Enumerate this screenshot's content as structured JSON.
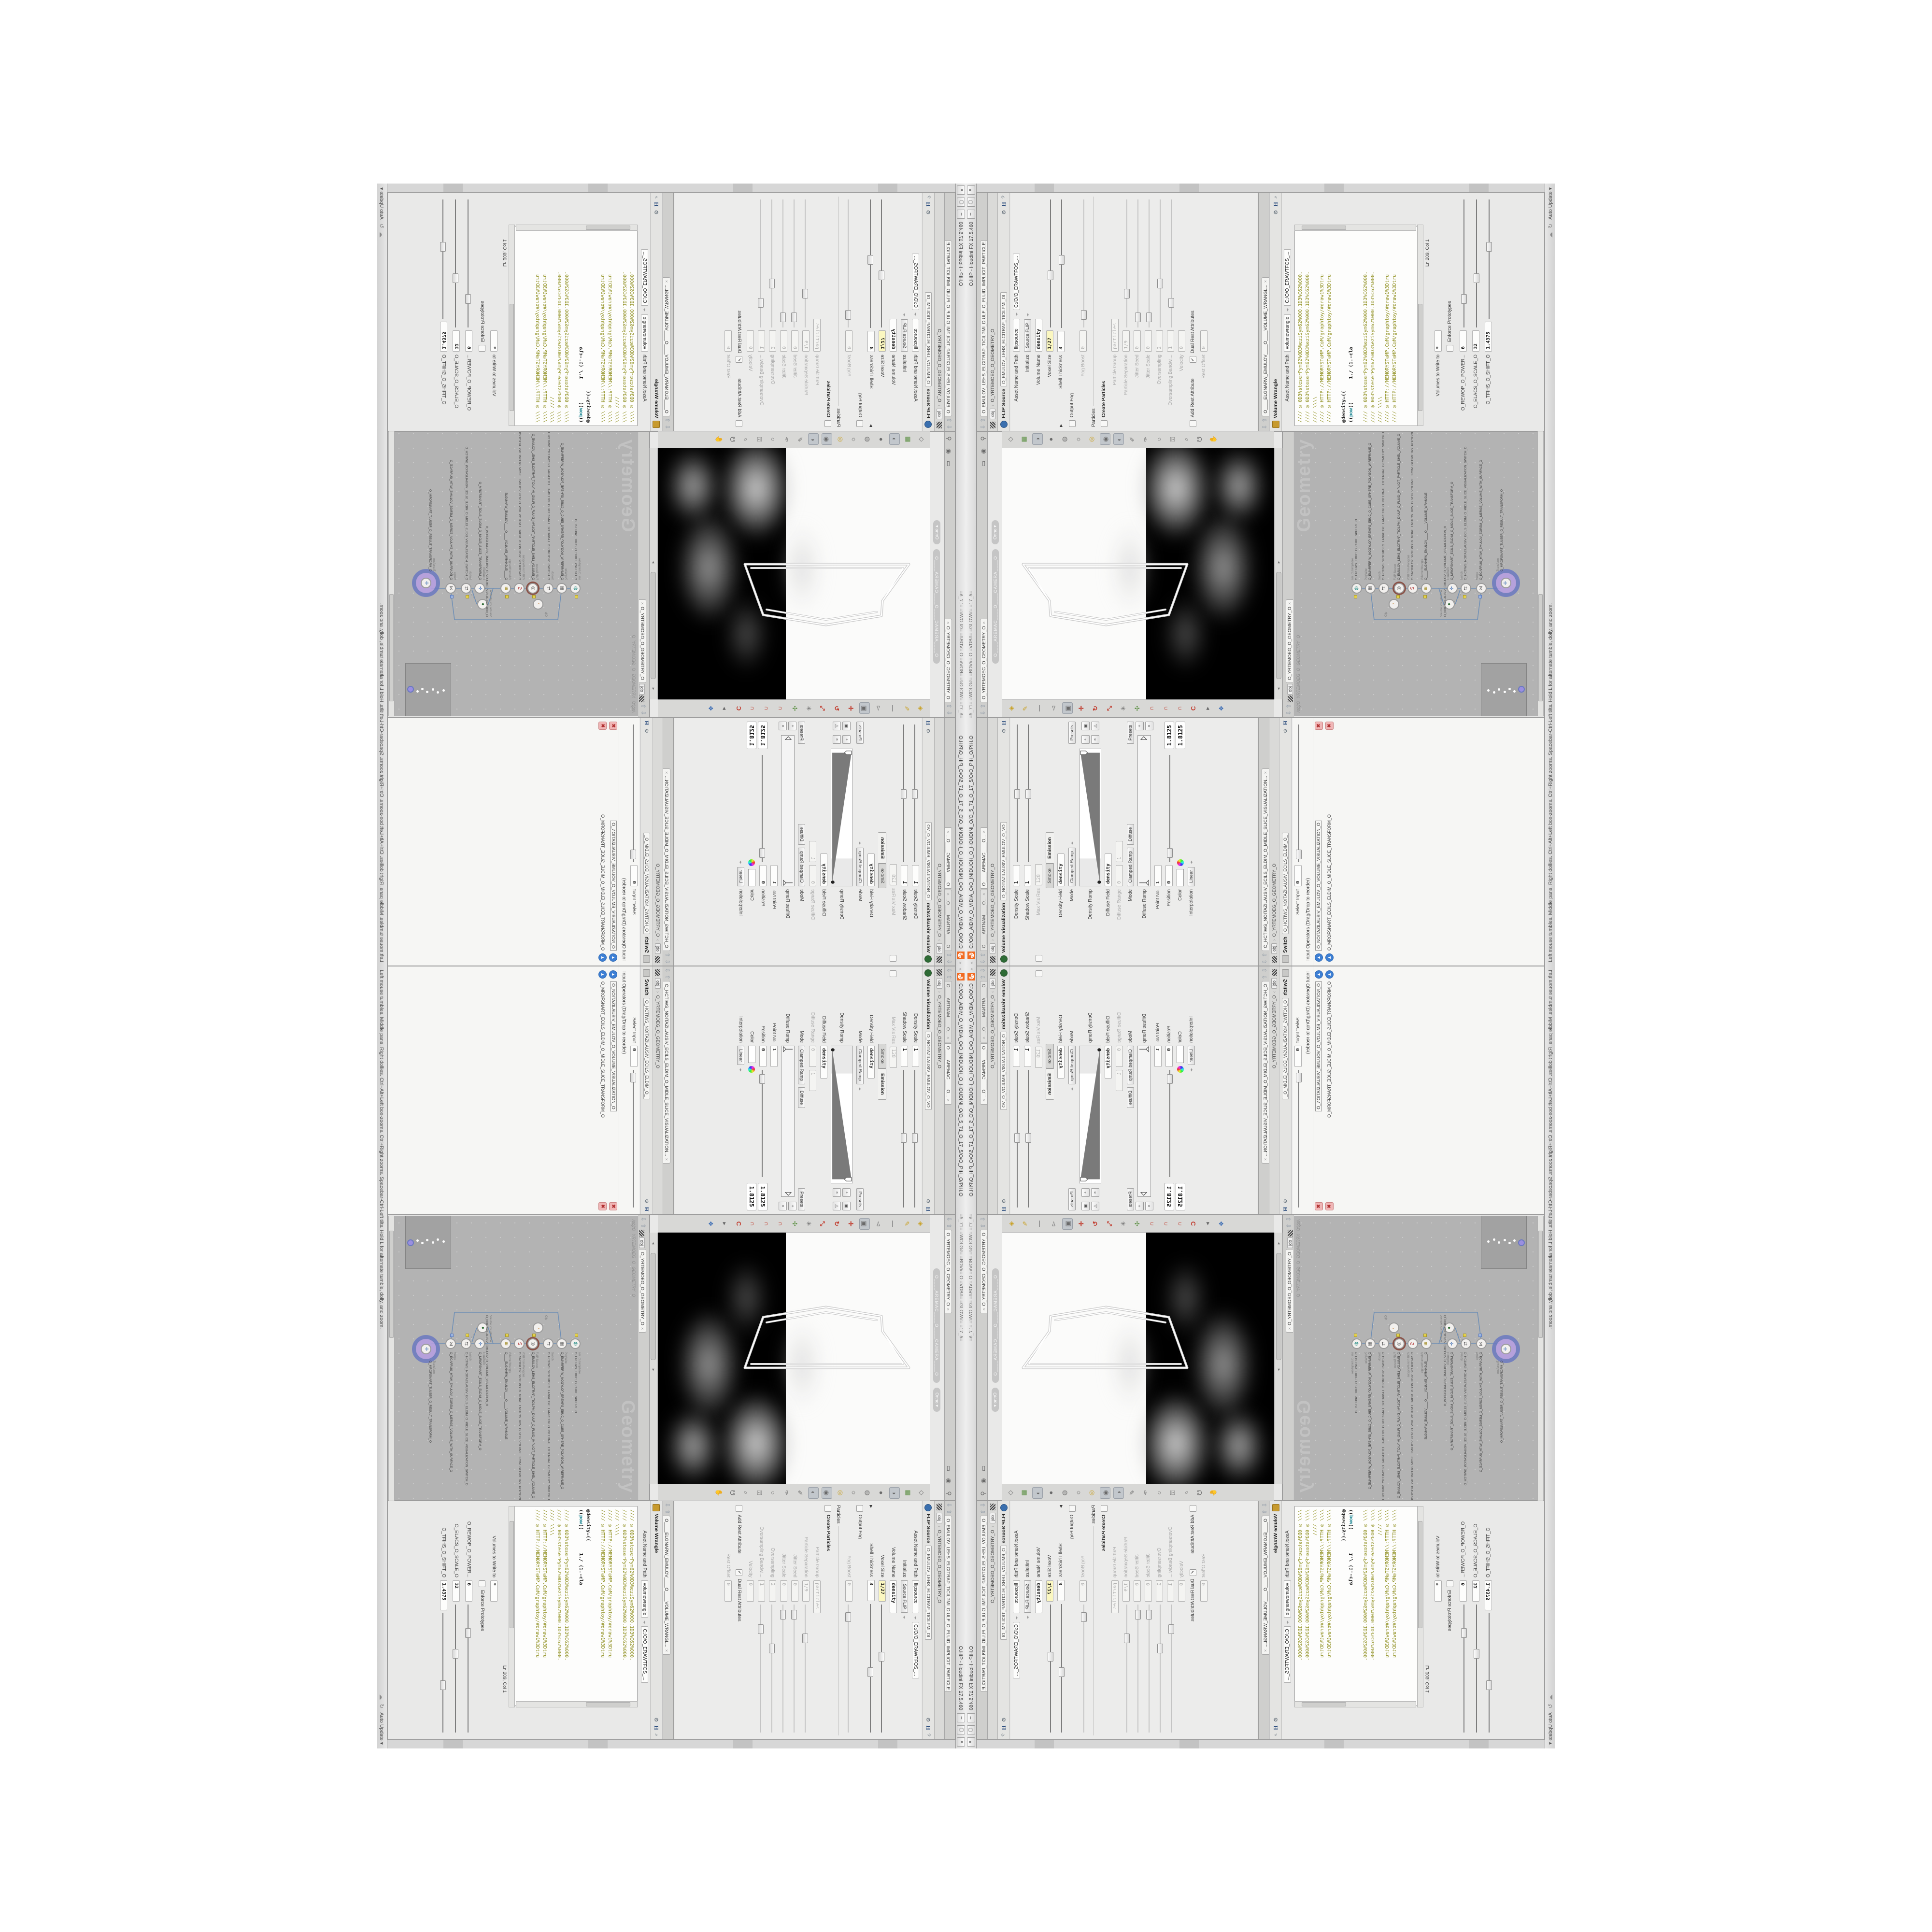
{
  "window": {
    "menu_arrows": "‹‹",
    "title_path": "C:/O/O_AIDIV_O_VIDIA_O/O_INIDUOH_O_HOUDINI_O/O_5_71_O_17_5/O/O_PIH_O/PIH.O",
    "title_flags": "=5_71=    =WOLG#= =BDV#=    O    =VDB#= =GLOW#=    =17_5=",
    "title_app": "O.HIP  -  Houdini FX 17.5.460",
    "btn_min": "–",
    "btn_max": "▢",
    "btn_close": "×"
  },
  "status": {
    "help": "Left mouse tumbles. Middle pans. Right dollies. Ctrl+Alt+Left box-zooms. Ctrl+Right zooms. Spacebar-Ctrl-Left tilts. Hold L for alternate tumble, dolly, and zoom.",
    "auto_update": "Auto Update"
  },
  "common": {
    "obj": "obj",
    "geo_node": "O_YRTEMOEG_O_GEOMETRY_O",
    "close": "×",
    "presets": "Presets"
  },
  "flip": {
    "tab": "O_EMULOV_LEHS_ELCITRAP_TICILPMI_DIULF_O_FLUID_IMPLICIT_PARTICLE...",
    "title": "FLIP Source",
    "node_tab": "O_EMULOV_LEHS_ELCITRAP_TICILPMI_DI",
    "asset_label": "Asset Name and Path",
    "asset_value": "flipsource",
    "asset_path": "C:/O/O_ERAWTFOS_...",
    "initialize_label": "Initialize",
    "initialize_value": "Source FLIP",
    "volume_name_label": "Volume Name",
    "volume_name_value": "density",
    "voxel_label": "Voxel Size",
    "voxel_value": "1/27",
    "shell_label": "Shell Thickness",
    "shell_value": "3",
    "output_fog_label": "Output Fog",
    "fog_boost_label": "Fog Boost",
    "fog_boost_value": "0",
    "particles_section": "Particles",
    "create_label": "Create Particles",
    "pgroup_label": "Particle Group",
    "pgroup_value": "particles",
    "psep_label": "Particle Separation",
    "psep_value": "1/9",
    "jseed_label": "Jitter Seed",
    "jseed_value": "0",
    "jscale_label": "Jitter Scale",
    "jscale_value": "0",
    "oversampling_label": "Oversampling",
    "oversampling_value": "2",
    "obw_label": "Oversampling Bandwi...",
    "obw_value": "1",
    "velocity_label": "Velocity",
    "velocity_value": "0",
    "addrest_label": "Add Rest Attribute",
    "dualrest_label": "Dual Rest Attributes",
    "restoffset_label": "Rest Offset",
    "restoffset_value": "0"
  },
  "wrangle": {
    "tab": "O____ELGNARW_EMULOV____O____VOLUME_WRANGL...",
    "title": "Volume Wrangle",
    "asset_label": "Asset Name and Path",
    "asset_value": "volumewrangle",
    "asset_path": "C:/O/O_ERAWTFOS_...",
    "code_top": [
      "//// ◎ 0D3%steserPym62%0D3%eziSym62%000.1D3%C62%000.",
      "//// ◎ 0D3%steserPym62%0D3%eziSym62%000.1D3%C62%000.",
      "//// \\\\\\\\",
      "//// ◎ HTTP://MEMORYST◎MP.C◎M/graphtoy/#draw1%3Dtru",
      "//// ◎ HTTP://MEMORYST◎MP.C◎M/graphtoy/#draw1%3Dtru"
    ],
    "code_mid1": "@density=((",
    "code_mid2a": "((",
    "code_mid2b": "pow",
    "code_mid2c": "((        1./ (1.-cla",
    "code_bot": [
      "//// ◎ 0D3%steserPym62%0D3%eziSym62%000.1D3%C62%000.",
      "//// ◎ 0D3%steserPym62%0D3%eziSym62%000.1D3%C62%000.",
      "//// \\\\\\\\",
      "//// ◎ HTTP://MEMORYST◎MP.C◎M/graphtoy/#draw1%3Dtru",
      "//// ◎ HTTP://MEMORYST◎MP.C◎M/graphtoy/#draw1%3Dtru"
    ],
    "cursor": "Ln 209, Col 1",
    "volumes_label": "Volumes to Write to",
    "volumes_value": "*",
    "enforce_label": "Enforce Prototypes",
    "p1_label": "O_REWOP_O_POWER...",
    "p1_value": "6",
    "p2_label": "O_ELACS_O_SCALE_O",
    "p2_value": "32",
    "p3_label": "O_TFIHS_O_SHIFT_O",
    "p3_value": "1.4375"
  },
  "volviz": {
    "tab1": "O____ARTNAM____O...",
    "tab2": "O____AREMAC____O...",
    "title": "Volume Visualization",
    "node_tab": "O_NOITAZILAUSIV_EMULOV_O_VO",
    "density_scale_label": "Density Scale",
    "density_scale_value": "1",
    "shadow_scale_label": "Shadow Scale",
    "shadow_scale_value": "1",
    "maxvis_label": "Max Vis Res",
    "maxvis_value": "128",
    "tab_smoke": "Smoke",
    "tab_emission": "Emission",
    "density_field_label": "Density Field",
    "density_field_value": "density",
    "mode_label": "Mode",
    "mode_value": "Clamped Ramp",
    "density_ramp_label": "Density Ramp",
    "diffuse_field_label": "Diffuse Field",
    "diffuse_field_value": "density",
    "diffuse_range_label": "Diffuse Range",
    "diffuse_range_v1": "0",
    "diffuse_range_v2": "1",
    "mode2_label": "Mode",
    "mode2_value": "Clamped Ramp",
    "diffuse_chip": "Diffuse",
    "diffuse_ramp_label": "Diffuse Ramp",
    "point_label": "Point No.",
    "point_value": "1",
    "position_label": "Position",
    "position_value": "0",
    "color_label": "Color",
    "interp_label": "Interpolation",
    "interp_value": "Linear",
    "big1": "1.8125",
    "big2": "1.8125"
  },
  "switchpane": {
    "tab": "O_HCTIWS_NOITAZILAUSIV_ECILS_ELDIM_O_MIDLE_SLICE_VISUALIZATION...",
    "title": "Switch",
    "node_tab": "O_HCTIWS_NOITAZILAUSIV_ECILS_ELDIM_O_",
    "select_label": "Select Input",
    "select_value": "0",
    "list_header": "Input Operators (Drag/Drop to reorder)",
    "item1": "O_NOITAZILAUSIV_EMULOV_O_VOLUME_VISUALIZATION_O",
    "item2": "O_MROFSNART_ECILS_ELDIM_O_MIDLE_SLICE_TRANSFORM_O"
  },
  "viewport": {
    "tab": "O_YRTEMOEG_O_GEOMETRY_O",
    "camera_pill": "O____AREMAC____O____CAMERA____O",
    "ortho": "Ortho"
  },
  "network": {
    "tab": "O_YRTEMOEG_O_GEOMETRY_O",
    "path": "/obj/O_YRTEMOEG_O_GEOMETRY_O",
    "watermark": "Geometry",
    "nodes": [
      {
        "cap": "am_CubeSphere",
        "label": "O_EREHPS_EBUC_O_CUBE_SPHERE_O"
      },
      {
        "cap": "PolyWire",
        "label": "O_EMARFERIW_NOGYLOP_EREHPS_EBUC_O_CUBE_SPHERE_POLYGON_WIREFRAME_O"
      },
      {
        "cap": "Switch",
        "label": "O_HCTIWS_YRTEMOEG_LANRETXE_LANRETNI_O_INTERNAL_EXTERNAL_GEOMETRY_SWITCH_O"
      },
      {
        "cap": "FLIP Source",
        "label": "O_EMULOV_LEHS_ELCITRAP_TICILPMI_DIULF_O_FLUID_IMPLICIT_PARTICLE_SHEL_VOLUME_O"
      },
      {
        "cap": "VDB from Polygons",
        "label": "O_SNOGILOP_YRTEMOEG_MORF_EMULOV_BDV_O_VDB_VOLUME_FROM_GEOMETRY_POLYGONS_O"
      },
      {
        "cap": "Volume Wrangle",
        "label": "O____ELGNARW_EMULOV____O____VOLUME_WRANGLE"
      },
      {
        "cap": "Volume Visualization",
        "label": "O_NOITAZILAUSIV_EMULOV_O_VOLUME_VISUALIZATION_O"
      },
      {
        "cap": "Transform",
        "label": "O_MROFSNART_ECILS_ELDIM_O_MIDLE_SLICE_TRANSFORM_O"
      },
      {
        "cap": "Switch",
        "label": "O_HCTIWS_NOITAZILAUSIV_ECILS_ELDIM_O_MIDLE_SLICE_VISUALIZATION_SWITCH_O"
      },
      {
        "cap": "Merge",
        "label": "O_ECAFRUS_HTIW_EMULOV_EGREM_O_MERGE_VOLUME_WITH_SURFACE_O"
      },
      {
        "cap": "Transform",
        "label": "O_MROFSNART_TLUSER_O_RESULT_TRANSFORM_O"
      },
      {
        "cap": "Clip",
        "label": "Clip"
      }
    ]
  }
}
